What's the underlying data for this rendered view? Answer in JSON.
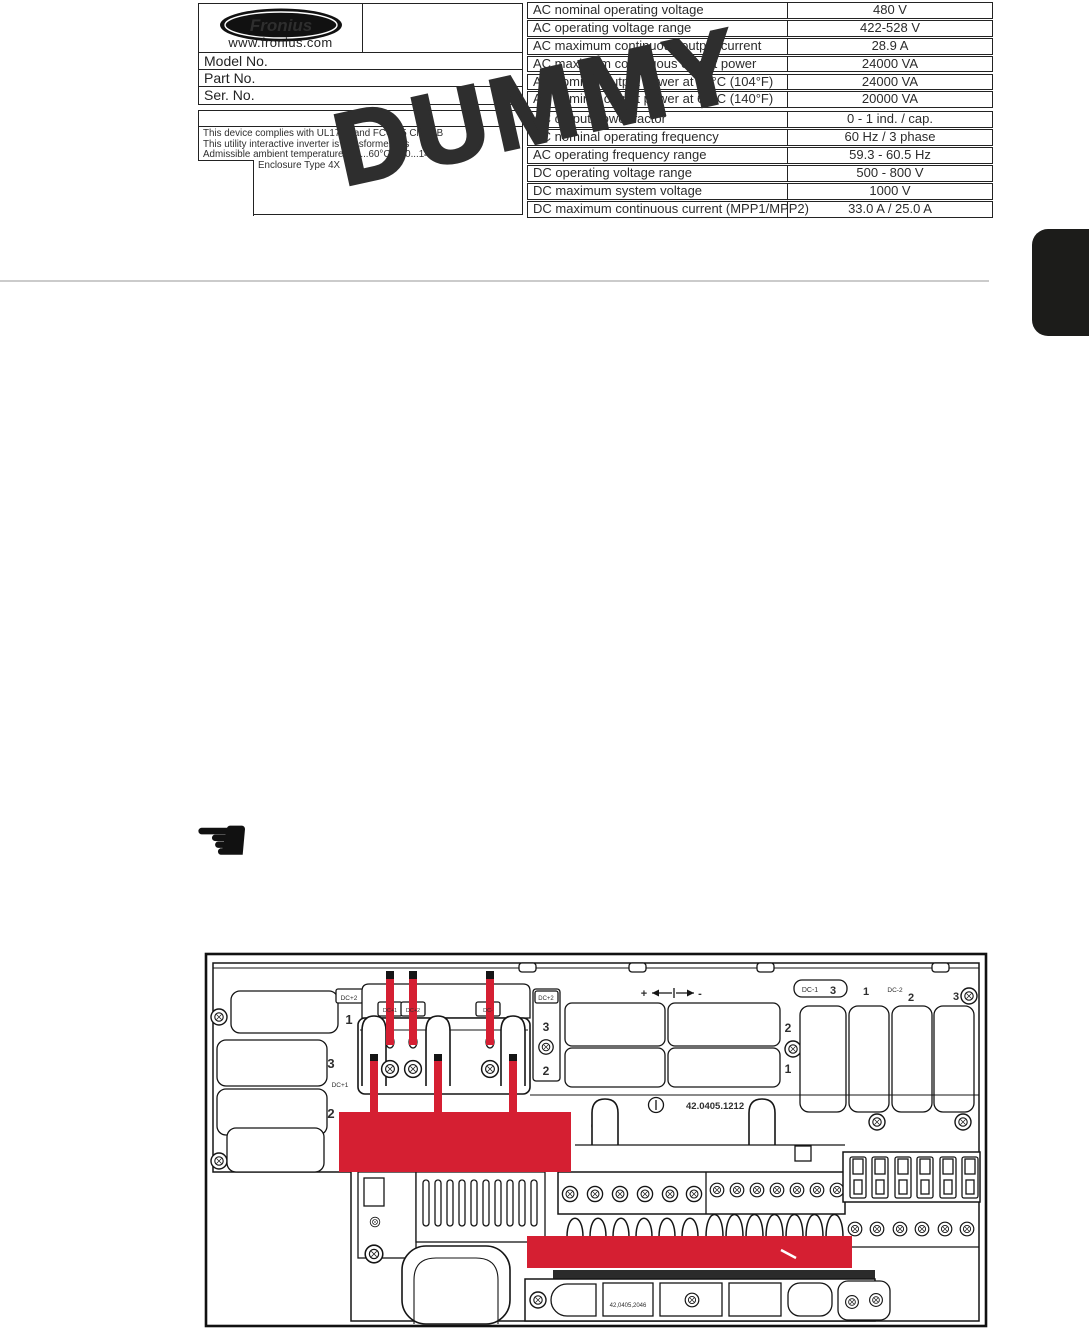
{
  "watermark": "DUMMY",
  "pointer": {
    "glyph": "☚",
    "meaning": "left-pointing-hand"
  },
  "rating_plate": {
    "brand": "Fronius",
    "website": "www.fronius.com",
    "fields": [
      "Model No.",
      "Part No.",
      "Ser. No."
    ],
    "compliance_lines": [
      "This device complies with UL1741 and FCC 15 Class B",
      "This utility interactive inverter is transformerless",
      "Admissible ambient temperature -40...60°C (-40...140°F)",
      "Enclosure Type 4X"
    ]
  },
  "spec_table": {
    "rows": [
      {
        "label": "AC nominal operating voltage",
        "value": "480 V"
      },
      {
        "label": "AC operating voltage range",
        "value": "422-528 V"
      },
      {
        "label": "AC maximum continuous output current",
        "value": "28.9 A"
      },
      {
        "label": "AC maximum continuous output power",
        "value": "24000 VA"
      },
      {
        "label": "AC nominal output power at 40°C (104°F)",
        "value": "24000 VA"
      },
      {
        "label": "AC nominal output power at 60°C (140°F)",
        "value": "20000 VA"
      },
      {
        "label": "AC output power factor",
        "value": "0 - 1 ind. / cap."
      },
      {
        "label": "AC nominal operating frequency",
        "value": "60 Hz / 3 phase"
      },
      {
        "label": "AC operating frequency range",
        "value": "59.3 - 60.5 Hz"
      },
      {
        "label": "DC operating voltage range",
        "value": "500 - 800 V"
      },
      {
        "label": "DC maximum system voltage",
        "value": "1000 V"
      },
      {
        "label": "DC maximum continuous current (MPP1/MPP2)",
        "value": "33.0 A / 25.0 A"
      }
    ]
  },
  "diagram": {
    "highlight_color": "#d51f32",
    "left": {
      "dc2": "DC+2",
      "n1": "1",
      "n3": "3",
      "dc1": "DC+1",
      "n2": "2"
    },
    "terminals": {
      "tab1": "DC+1",
      "tab2": "DC+2",
      "tab3": "DC-",
      "side_label": "DC+2",
      "side_top": "3",
      "side_bottom": "2"
    },
    "polarity": {
      "plus": "+",
      "minus": "-"
    },
    "center": {
      "n2": "2",
      "n1": "1",
      "part_number": "42.0405.1212"
    },
    "right": {
      "dc1": "DC-1",
      "n3a": "3",
      "n1": "1",
      "dc2": "DC-2",
      "n2": "2",
      "n3b": "3"
    },
    "bottom": {
      "part_number": "42,0405,2046"
    }
  }
}
